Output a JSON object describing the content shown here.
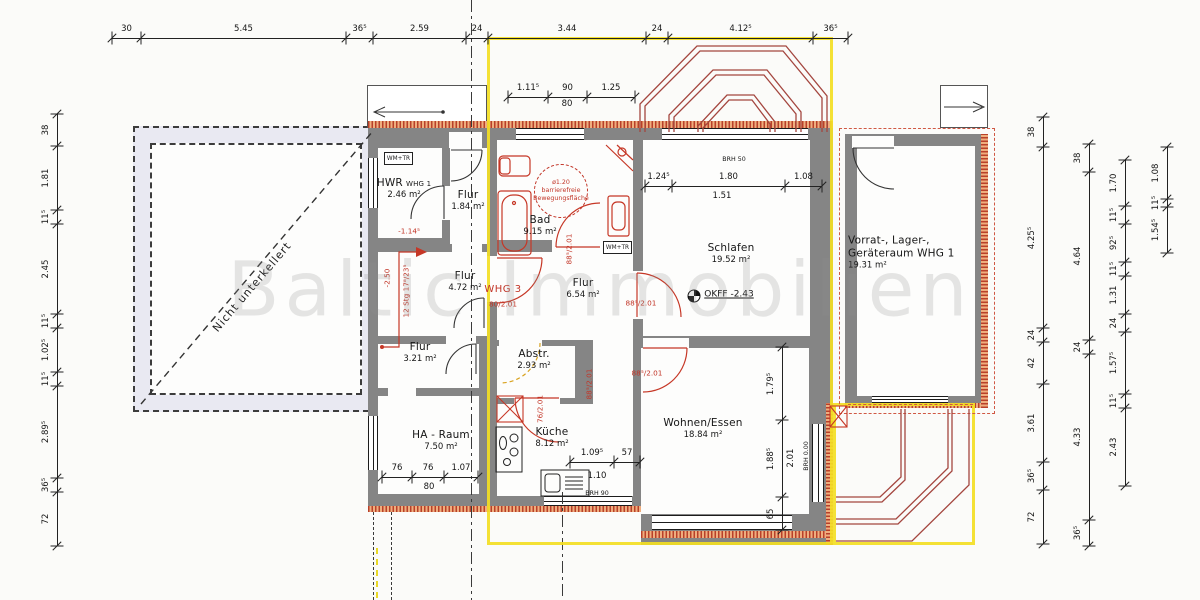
{
  "watermark": "Baltic Immobilien",
  "terrace_note": "Nicht unterkellert",
  "colors": {
    "wall_gray": "#858585",
    "highlight_yellow": "#f3de24",
    "annotation_red": "#c23527",
    "insulation_hatch": "#b8402a",
    "terrace_fill": "#e9e9f2"
  },
  "rooms": [
    {
      "name": "HWR",
      "suffix": "WHG 1",
      "area": "2.46 m²",
      "x": 404,
      "y": 189
    },
    {
      "name": "Flur",
      "area": "1.84 m²",
      "x": 468,
      "y": 201
    },
    {
      "name": "Bad",
      "area": "9.15 m²",
      "x": 540,
      "y": 226
    },
    {
      "name": "Schlafen",
      "area": "19.52 m²",
      "x": 731,
      "y": 254
    },
    {
      "name": "Vorrat-, Lager-,",
      "name2": "Geräteraum WHG 1",
      "area": "19.31 m²",
      "x": 848,
      "y": 253,
      "align": "left"
    },
    {
      "name": "Flur",
      "area": "4.72 m²",
      "x": 465,
      "y": 282
    },
    {
      "name": "Flur",
      "area": "6.54 m²",
      "x": 583,
      "y": 289
    },
    {
      "name": "Flur",
      "area": "3.21 m²",
      "x": 420,
      "y": 353
    },
    {
      "name": "Abstr.",
      "area": "2.93 m²",
      "x": 534,
      "y": 360
    },
    {
      "name": "HA - Raum",
      "area": "7.50 m²",
      "x": 441,
      "y": 441
    },
    {
      "name": "Küche",
      "area": "8.12 m²",
      "x": 552,
      "y": 438
    },
    {
      "name": "Wohnen/Essen",
      "area": "18.84 m²",
      "x": 703,
      "y": 429
    }
  ],
  "dim_chains": [
    {
      "id": "top",
      "axis": "h",
      "line": 38,
      "boundaries": [
        112,
        141,
        346,
        373,
        466,
        488,
        646,
        668,
        813,
        848
      ],
      "labels": [
        "30",
        "5.45",
        "36⁵",
        "2.59",
        "24",
        "3.44",
        "24",
        "4.12⁵",
        "36⁵"
      ]
    },
    {
      "id": "top-inner",
      "axis": "h",
      "line": 97,
      "boundaries": [
        508,
        548,
        587,
        635
      ],
      "labels": [
        "1.11⁵",
        "90",
        "1.25"
      ]
    },
    {
      "id": "schlafen-window",
      "axis": "h",
      "line": 186,
      "boundaries": [
        645,
        672,
        785,
        822
      ],
      "labels": [
        "1.24⁵",
        "1.80",
        "1.08"
      ]
    },
    {
      "id": "kueche",
      "axis": "h",
      "line": 462,
      "boundaries": [
        570,
        614,
        640
      ],
      "labels": [
        "1.09⁵",
        "57"
      ]
    },
    {
      "id": "ha-raum",
      "axis": "h",
      "line": 477,
      "boundaries": [
        382,
        412,
        444,
        478
      ],
      "labels": [
        "76",
        "76",
        "1.07"
      ]
    },
    {
      "id": "left",
      "axis": "v",
      "line": 57,
      "boundaries": [
        114,
        146,
        210,
        224,
        314,
        328,
        372,
        386,
        478,
        492,
        546
      ],
      "labels": [
        "38",
        "1.81",
        "11⁵",
        "2.45",
        "11⁵",
        "1.02⁵",
        "11⁵",
        "2.89⁵",
        "36⁵",
        "72"
      ]
    },
    {
      "id": "right-outer",
      "axis": "v",
      "line": 1043,
      "boundaries": [
        117,
        147,
        328,
        342,
        384,
        462,
        490,
        544
      ],
      "labels": [
        "38",
        "4.25⁵",
        "24",
        "42",
        "3.61",
        "36⁵",
        "72"
      ]
    },
    {
      "id": "right-mid",
      "axis": "v",
      "line": 1089,
      "boundaries": [
        144,
        172,
        340,
        354,
        520,
        546
      ],
      "labels": [
        "38",
        "4.64",
        "24",
        "4.33",
        "36⁵"
      ]
    },
    {
      "id": "right-inner",
      "axis": "v",
      "line": 1125,
      "boundaries": [
        160,
        206,
        224,
        262,
        276,
        314,
        332,
        394,
        408,
        486
      ],
      "labels": [
        "1.70",
        "11⁵",
        "92⁵",
        "11⁵",
        "1.31",
        "24",
        "1.57⁵",
        "11⁵",
        "2.43"
      ]
    },
    {
      "id": "right-inner2",
      "axis": "v",
      "line": 1167,
      "boundaries": [
        147,
        199,
        207,
        253
      ],
      "labels": [
        "1.08",
        "11⁵",
        "1.54⁵"
      ]
    },
    {
      "id": "wohnen",
      "axis": "v",
      "line": 782,
      "boundaries": [
        347,
        420,
        497,
        530
      ],
      "labels": [
        "1.79⁵",
        "1.88⁵",
        "65"
      ]
    }
  ],
  "annotations": [
    {
      "t": "80",
      "x": 567,
      "y": 104,
      "cls": ""
    },
    {
      "t": "1.51",
      "x": 722,
      "y": 196,
      "cls": ""
    },
    {
      "t": "80",
      "x": 429,
      "y": 487,
      "cls": ""
    },
    {
      "t": "1.10",
      "x": 597,
      "y": 476,
      "cls": ""
    },
    {
      "t": "BRH 90",
      "x": 597,
      "y": 494,
      "cls": "tiny"
    },
    {
      "t": "BRH 50",
      "x": 734,
      "y": 160,
      "cls": "tiny"
    },
    {
      "t": "OKFF -2.43",
      "x": 729,
      "y": 295,
      "cls": "okff"
    },
    {
      "t": "2.01",
      "x": 791,
      "y": 458,
      "cls": "rot"
    },
    {
      "t": "BRH 0.00",
      "x": 807,
      "y": 456,
      "cls": "tiny rot"
    },
    {
      "t": "WHG 3",
      "x": 503,
      "y": 290,
      "cls": "red whg"
    },
    {
      "t": "80/2.01",
      "x": 503,
      "y": 304,
      "cls": "red sm"
    },
    {
      "t": "88⁵/2.01",
      "x": 641,
      "y": 303,
      "cls": "red sm"
    },
    {
      "t": "88⁵/2.01",
      "x": 647,
      "y": 373,
      "cls": "red sm"
    },
    {
      "t": "88⁵/2.01",
      "x": 569,
      "y": 249,
      "cls": "red sm rot"
    },
    {
      "t": "88⁵/2.01",
      "x": 589,
      "y": 384,
      "cls": "red sm rot"
    },
    {
      "t": "76/2.01",
      "x": 540,
      "y": 409,
      "cls": "red sm rot"
    },
    {
      "t": "-1.14⁵",
      "x": 409,
      "y": 231,
      "cls": "red sm"
    },
    {
      "t": "-2.50",
      "x": 387,
      "y": 278,
      "cls": "red sm rot"
    },
    {
      "t": "12 Stg 17⁸/23⁵",
      "x": 406,
      "y": 291,
      "cls": "red sm rot"
    },
    {
      "t": "ø1.20",
      "x": 561,
      "y": 183,
      "cls": "red tiny"
    },
    {
      "t": "barrierefreie",
      "x": 561,
      "y": 191,
      "cls": "red tiny"
    },
    {
      "t": "Bewegungsfläche",
      "x": 561,
      "y": 199,
      "cls": "red tiny"
    }
  ],
  "appliance_boxes": [
    {
      "label": "WM+TR",
      "x": 384,
      "y": 152,
      "w": 29,
      "h": 13
    },
    {
      "label": "WM+TR",
      "x": 603,
      "y": 241,
      "w": 29,
      "h": 13
    }
  ]
}
